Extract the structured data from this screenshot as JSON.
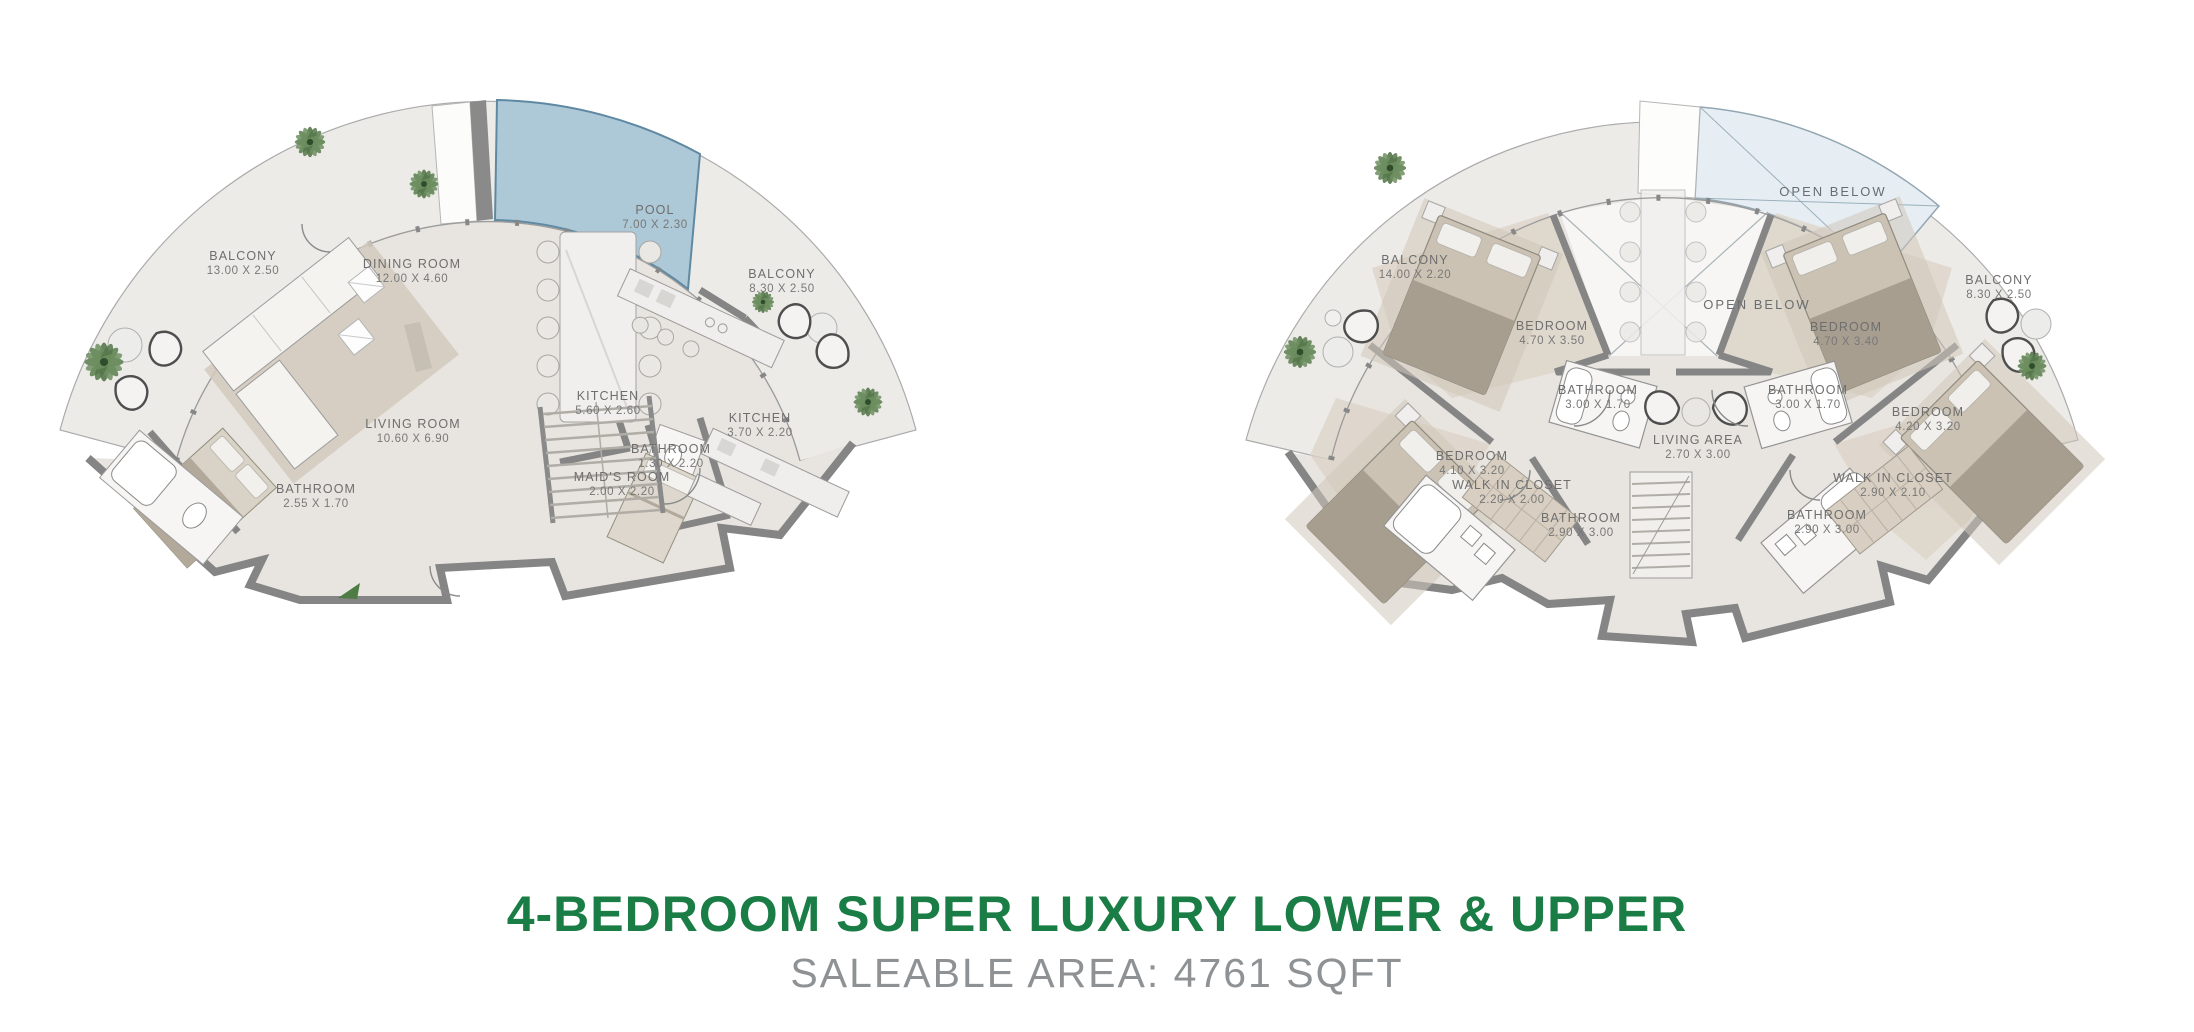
{
  "title": {
    "line1": "4-BEDROOM SUPER LUXURY LOWER & UPPER",
    "line2": "SALEABLE AREA: 4761 SQFT"
  },
  "colors": {
    "accent_green": "#1b7d46",
    "subtitle_gray": "#8f9294",
    "pool_blue": "#adc8d6",
    "open_below_blue": "#e6eef3",
    "wall_gray": "#858585",
    "floor": "#e8e5e0",
    "balcony": "#edebe7",
    "plant_green": "#628455"
  },
  "lower_plan": {
    "labels": [
      {
        "name": "BALCONY",
        "dims": "13.00 X 2.50"
      },
      {
        "name": "DINING ROOM",
        "dims": "12.00 X 4.60"
      },
      {
        "name": "POOL",
        "dims": "7.00 X 2.30"
      },
      {
        "name": "BALCONY",
        "dims": "8.30 X 2.50"
      },
      {
        "name": "LIVING ROOM",
        "dims": "10.60 X 6.90"
      },
      {
        "name": "KITCHEN",
        "dims": "5.60 X 2.60"
      },
      {
        "name": "KITCHEN",
        "dims": "3.70 X 2.20"
      },
      {
        "name": "BATHROOM",
        "dims": "1.30 X 2.20"
      },
      {
        "name": "MAID'S ROOM",
        "dims": "2.00 X 2.20"
      },
      {
        "name": "BATHROOM",
        "dims": "2.55 X 1.70"
      }
    ]
  },
  "upper_plan": {
    "labels": [
      {
        "name": "BALCONY",
        "dims": "14.00 X 2.20"
      },
      {
        "name": "OPEN BELOW",
        "dims": ""
      },
      {
        "name": "OPEN BELOW",
        "dims": ""
      },
      {
        "name": "BALCONY",
        "dims": "8.30 X 2.50"
      },
      {
        "name": "BEDROOM",
        "dims": "4.70 X 3.50"
      },
      {
        "name": "BATHROOM",
        "dims": "3.00 X 1.70"
      },
      {
        "name": "BEDROOM",
        "dims": "4.10 X 3.20"
      },
      {
        "name": "WALK IN CLOSET",
        "dims": "2.20 X 2.00"
      },
      {
        "name": "BATHROOM",
        "dims": "2.90 X 3.00"
      },
      {
        "name": "LIVING AREA",
        "dims": "2.70 X 3.00"
      },
      {
        "name": "BATHROOM",
        "dims": "3.00 X 1.70"
      },
      {
        "name": "BEDROOM",
        "dims": "4.70 X 3.40"
      },
      {
        "name": "BEDROOM",
        "dims": "4.20 X 3.20"
      },
      {
        "name": "WALK IN CLOSET",
        "dims": "2.90 X 2.10"
      },
      {
        "name": "BATHROOM",
        "dims": "2.90 X 3.00"
      }
    ]
  }
}
